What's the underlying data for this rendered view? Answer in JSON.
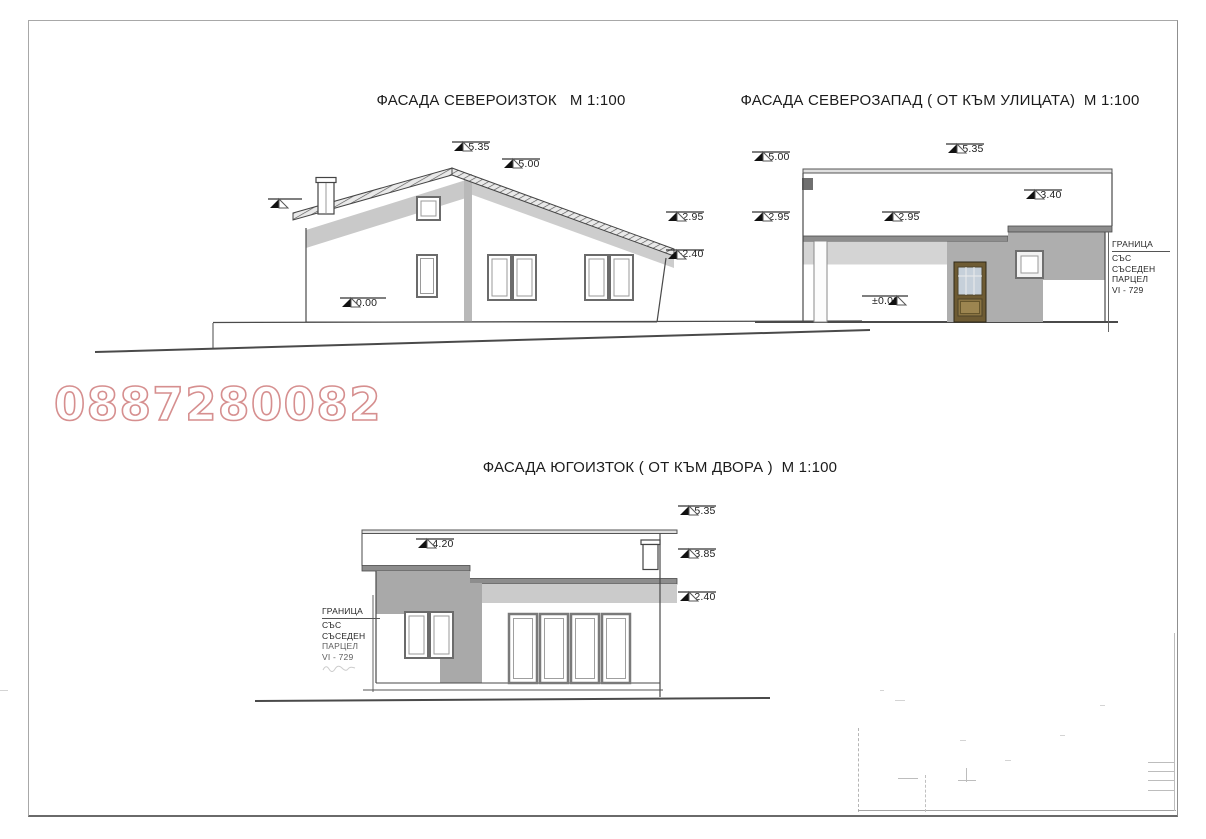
{
  "watermark": {
    "text": "0887280082",
    "color": "#d68f8f"
  },
  "facades": [
    {
      "id": "northeast",
      "title": "ФАСАДА СЕВЕРОИЗТОК   М 1:100",
      "markers": [
        {
          "label": "+5.35"
        },
        {
          "label": "+5.00"
        },
        {
          "label": "+2.95"
        },
        {
          "label": "+2.40"
        },
        {
          "label": "±0.00"
        }
      ]
    },
    {
      "id": "northwest-street",
      "title": "ФАСАДА СЕВЕРОЗАПАД ( ОТ КЪМ УЛИЦАТА)  М 1:100",
      "markers": [
        {
          "label": "+5.00"
        },
        {
          "label": "+5.35"
        },
        {
          "label": "+2.95"
        },
        {
          "label": "+2.95"
        },
        {
          "label": "+3.40"
        },
        {
          "label": "±0.00"
        }
      ],
      "boundary_note": {
        "lines": [
          "ГРАНИЦА",
          "СЪС",
          "СЪСЕДЕН",
          "ПАРЦЕЛ",
          "VI - 729"
        ]
      }
    },
    {
      "id": "southeast-yard",
      "title": "ФАСАДА ЮГОИЗТОК ( ОТ КЪМ ДВОРА )  М 1:100",
      "markers": [
        {
          "label": "+4.20"
        },
        {
          "label": "+5.35"
        },
        {
          "label": "+3.85"
        },
        {
          "label": "+2.40"
        }
      ],
      "boundary_note": {
        "lines": [
          "ГРАНИЦА",
          "СЪС",
          "СЪСЕДЕН",
          "ПАРЦЕЛ",
          "VI - 729"
        ]
      }
    }
  ]
}
